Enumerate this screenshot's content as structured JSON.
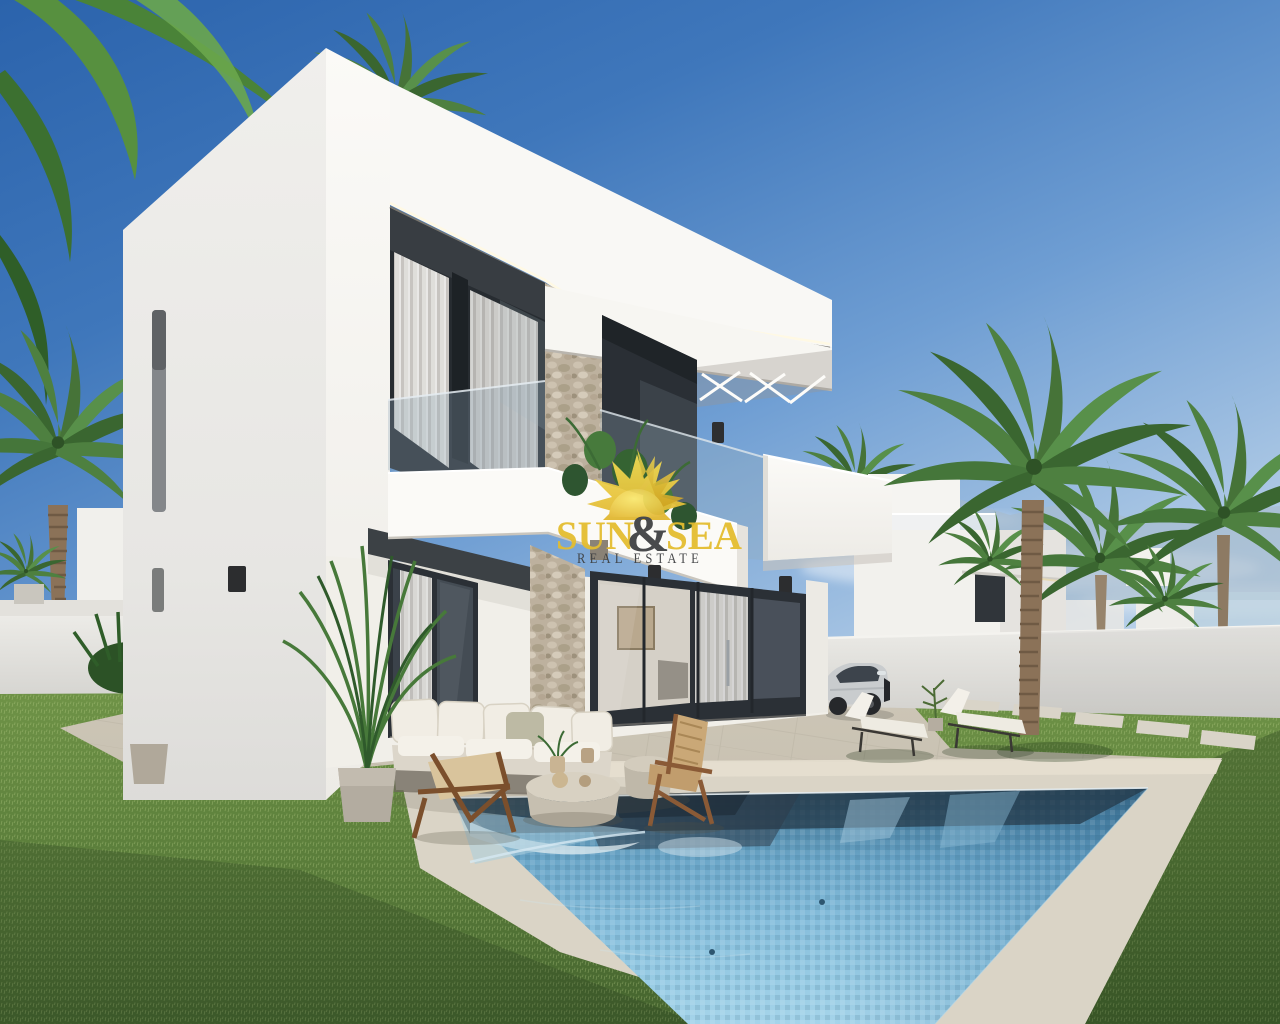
{
  "title": "New build modern villa with private pool – agency photo render",
  "watermark": {
    "brand": "SUN & SEA REAL ESTATE",
    "sun": "SUN",
    "ampersand": "&",
    "sea": "SEA",
    "tagline": "REAL ESTATE"
  },
  "scene": {
    "description": "Photorealistic render of a two-storey cubic white villa seen from its corner, with a glass-balustrade balcony, stone-clad pillar, anthracite sliding doors, travertine terrace, rectangular blue pool, lawns, palm trees, outdoor lounge furniture, two sun loungers, a silver SUV parked by the boundary wall and neighbouring white villas under a clear blue sky. A yellow 'SUN & SEA – REAL ESTATE' sun-logo watermark sits at the centre of the image.",
    "objects": [
      "white two-storey villa",
      "roof LED cove",
      "upper window with white curtains",
      "glass balcony balustrade",
      "stone feature pillar",
      "balcony plants",
      "white cantilever slab",
      "projecting white terrace box",
      "dark wall sconces",
      "anthracite sliding glass doors",
      "interior with framed art",
      "outdoor sofa with cream cushions",
      "two wooden lounge chairs",
      "round stone coffee tables with plants and spheres",
      "potted areca palms",
      "travertine terrace",
      "rectangular swimming pool",
      "two sun loungers with white pads",
      "small potted sapling",
      "stepping stones on lawn",
      "green lawns",
      "white boundary walls",
      "date palm left",
      "palm cluster right",
      "tall palm inside garden",
      "neighbouring white villas",
      "hazy mountains and sea horizon",
      "silver SUV car",
      "hanging palm fronds top left",
      "palm crown above roof"
    ],
    "sky": "clear gradient sky, deep blue upper left to pale haze at horizon",
    "time_of_day": "bright sunny daytime"
  },
  "colors": {
    "sky_top": "#2b63ac",
    "sky_horizon": "#d7e4f1",
    "logo_yellow": "#e4bd2f",
    "logo_dark": "#3e4042",
    "villa_white": "#f6f5f2",
    "frame_anthracite": "#2b3036",
    "stone_beige": "#bdb19e",
    "pavement": "#c9c2b3",
    "pool_dark": "#355a70",
    "pool_light": "#a5d4ea",
    "grass": "#5f8038",
    "palm_green": "#4e8040",
    "wood_brown": "#7b4f2c",
    "car_silver": "#c9ccce"
  }
}
